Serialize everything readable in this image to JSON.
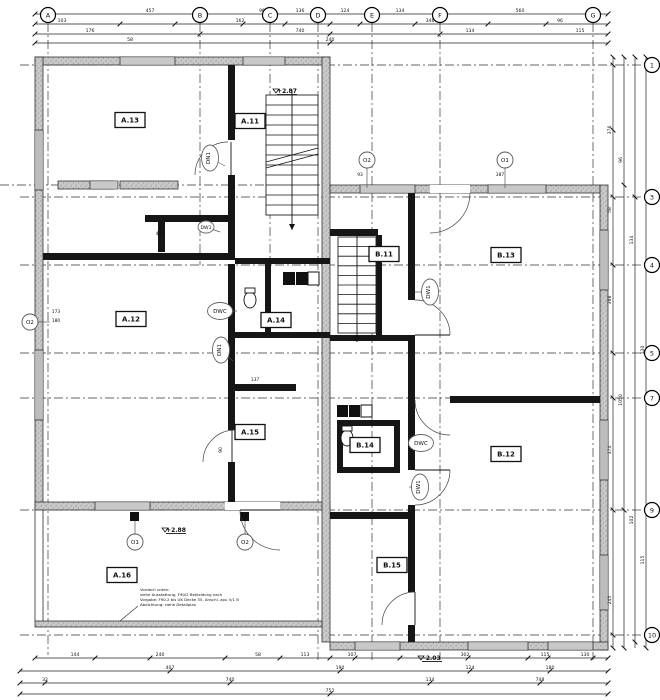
{
  "drawing": {
    "kind": "architectural-floor-plan"
  },
  "rooms": [
    {
      "id": "A.13",
      "x": 130,
      "y": 120
    },
    {
      "id": "A.11",
      "x": 250,
      "y": 121
    },
    {
      "id": "A.12",
      "x": 131,
      "y": 319
    },
    {
      "id": "A.14",
      "x": 276,
      "y": 320
    },
    {
      "id": "A.15",
      "x": 250,
      "y": 432
    },
    {
      "id": "A.16",
      "x": 122,
      "y": 575
    },
    {
      "id": "B.11",
      "x": 384,
      "y": 254
    },
    {
      "id": "B.13",
      "x": 506,
      "y": 255
    },
    {
      "id": "B.12",
      "x": 506,
      "y": 454
    },
    {
      "id": "B.14",
      "x": 365,
      "y": 445
    },
    {
      "id": "B.15",
      "x": 392,
      "y": 565
    }
  ],
  "fixture_markers": [
    {
      "label": "DN1",
      "x": 210,
      "y": 158,
      "vertical": true,
      "lx": 225,
      "ly": 166
    },
    {
      "label": "DW1",
      "x": 206,
      "y": 227,
      "vertical": false,
      "small": true,
      "lx": 220,
      "ly": 232
    },
    {
      "label": "DWC",
      "x": 220,
      "y": 311,
      "vertical": false,
      "lx": 237,
      "ly": 311
    },
    {
      "label": "DN1",
      "x": 221,
      "y": 350,
      "vertical": true,
      "lx": 233,
      "ly": 361
    },
    {
      "label": "DW1",
      "x": 430,
      "y": 292,
      "vertical": true,
      "lx": 415,
      "ly": 292
    },
    {
      "label": "DWC",
      "x": 421,
      "y": 443,
      "vertical": false,
      "lx": 408,
      "ly": 443
    },
    {
      "label": "DW1",
      "x": 420,
      "y": 487,
      "vertical": true,
      "lx": 409,
      "ly": 487
    }
  ],
  "grid_top": [
    {
      "label": "A",
      "x": 48
    },
    {
      "label": "B",
      "x": 200
    },
    {
      "label": "C",
      "x": 270
    },
    {
      "label": "D",
      "x": 318
    },
    {
      "label": "E",
      "x": 372
    },
    {
      "label": "F",
      "x": 440
    },
    {
      "label": "G",
      "x": 593
    }
  ],
  "grid_right": [
    {
      "label": "1",
      "y": 65
    },
    {
      "label": "3",
      "y": 197
    },
    {
      "label": "4",
      "y": 265
    },
    {
      "label": "5",
      "y": 353
    },
    {
      "label": "7",
      "y": 398
    },
    {
      "label": "9",
      "y": 510
    },
    {
      "label": "10",
      "y": 635
    }
  ],
  "opening_markers": [
    {
      "label": "O2",
      "x": 30,
      "y": 322
    },
    {
      "label": "O2",
      "x": 367,
      "y": 160
    },
    {
      "label": "O1",
      "x": 505,
      "y": 160
    },
    {
      "label": "O1",
      "x": 135,
      "y": 542
    },
    {
      "label": "O2",
      "x": 245,
      "y": 542
    }
  ],
  "elevations": [
    {
      "value": "+2.87",
      "x": 287,
      "y": 93
    },
    {
      "value": "+2.88",
      "x": 176,
      "y": 532
    },
    {
      "value": "-2.03",
      "x": 432,
      "y": 660
    }
  ],
  "dimensions": {
    "top": [
      {
        "nums": [
          {
            "t": "457",
            "x": 150
          },
          {
            "t": "96",
            "x": 262
          },
          {
            "t": "136",
            "x": 300
          },
          {
            "t": "124",
            "x": 345
          },
          {
            "t": "134",
            "x": 400
          },
          {
            "t": "560",
            "x": 520
          }
        ]
      },
      {
        "nums": [
          {
            "t": "103",
            "x": 62
          },
          {
            "t": "162",
            "x": 240
          },
          {
            "t": "346",
            "x": 430
          },
          {
            "t": "96",
            "x": 560
          }
        ]
      },
      {
        "nums": [
          {
            "t": "176",
            "x": 90
          },
          {
            "t": "740",
            "x": 300
          },
          {
            "t": "134",
            "x": 470
          },
          {
            "t": "115",
            "x": 580
          }
        ]
      },
      {
        "nums": [
          {
            "t": "58",
            "x": 130
          },
          {
            "t": "240",
            "x": 330
          }
        ]
      }
    ],
    "right": [
      {
        "nums": [
          {
            "t": "376",
            "y": 130
          },
          {
            "t": "58",
            "y": 210
          },
          {
            "t": "368",
            "y": 300
          },
          {
            "t": "374",
            "y": 450
          },
          {
            "t": "245",
            "y": 600
          }
        ]
      },
      {
        "nums": [
          {
            "t": "96",
            "y": 160
          },
          {
            "t": "1050",
            "y": 400
          }
        ]
      },
      {
        "nums": [
          {
            "t": "134",
            "y": 240
          },
          {
            "t": "102",
            "y": 520
          }
        ]
      },
      {
        "nums": [
          {
            "t": "130",
            "y": 350
          },
          {
            "t": "115",
            "y": 560
          }
        ]
      }
    ],
    "bottom": [
      {
        "nums": [
          {
            "t": "144",
            "x": 75
          },
          {
            "t": "240",
            "x": 160
          },
          {
            "t": "58",
            "x": 258
          },
          {
            "t": "113",
            "x": 305
          },
          {
            "t": "107",
            "x": 352
          },
          {
            "t": "302",
            "x": 465
          },
          {
            "t": "115",
            "x": 545
          },
          {
            "t": "130",
            "x": 585
          }
        ]
      },
      {
        "nums": [
          {
            "t": "407",
            "x": 170
          },
          {
            "t": "190",
            "x": 340
          },
          {
            "t": "124",
            "x": 470
          },
          {
            "t": "180",
            "x": 550
          }
        ]
      },
      {
        "nums": [
          {
            "t": "32",
            "x": 45
          },
          {
            "t": "740",
            "x": 230
          },
          {
            "t": "134",
            "x": 430
          },
          {
            "t": "748",
            "x": 540
          }
        ]
      },
      {
        "nums": [
          {
            "t": "752",
            "x": 330
          }
        ]
      }
    ],
    "inner": [
      {
        "t": "173",
        "x": 56,
        "y": 313
      },
      {
        "t": "180",
        "x": 56,
        "y": 322
      },
      {
        "t": "458",
        "x": 160,
        "y": 235
      },
      {
        "t": "93",
        "x": 360,
        "y": 176
      },
      {
        "t": "387",
        "x": 500,
        "y": 176
      },
      {
        "t": "137",
        "x": 255,
        "y": 381
      },
      {
        "t": "90",
        "x": 222,
        "y": 450,
        "rot": -90
      }
    ]
  },
  "note": {
    "lines": [
      "Vordach unten:",
      "siehe Ausstattung, F90/2 Bekleidung nach",
      "Vorgabe: F90.2 bis UK Decke 35, Anschl. apu 5/1 B",
      "Abdichtung: siehe Detailplan"
    ]
  }
}
